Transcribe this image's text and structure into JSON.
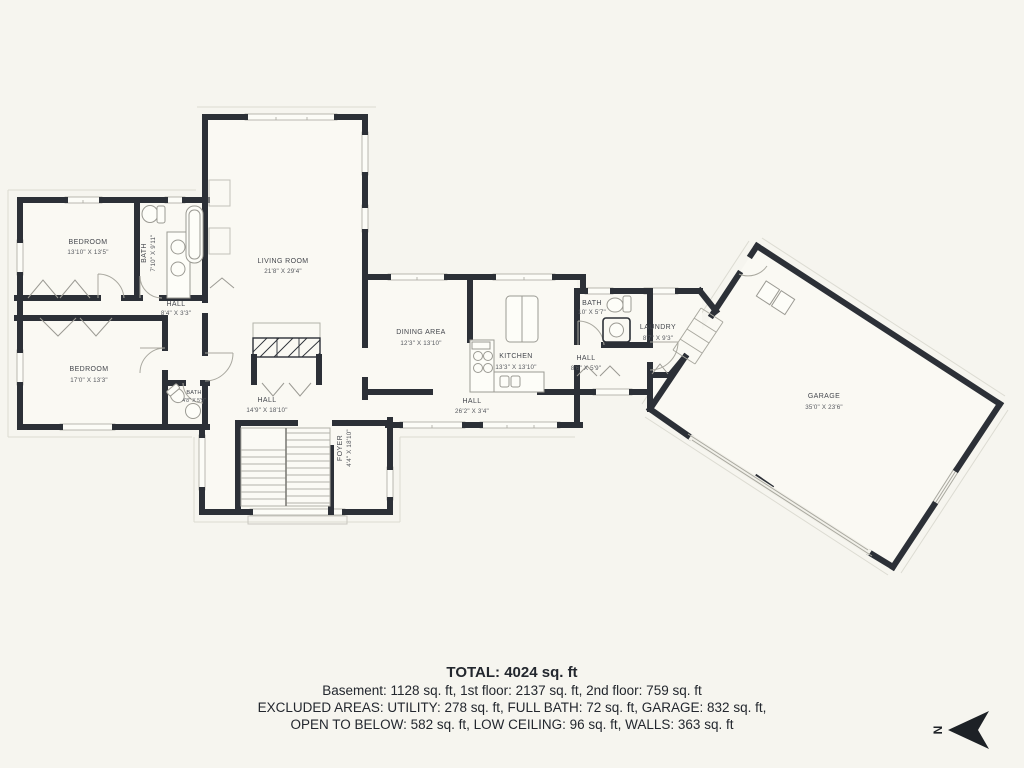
{
  "title": "Floor plan",
  "colors": {
    "background": "#f6f5ef",
    "wall": "#2c3037",
    "thin_line": "#a9a89f",
    "eave_line": "#dcdbd2",
    "label": "#44474d"
  },
  "rooms": {
    "living_room": {
      "name": "LIVING ROOM",
      "dims": "21'8\" X 29'4\""
    },
    "bedroom_upper": {
      "name": "BEDROOM",
      "dims": "13'10\" X 13'5\""
    },
    "bath_upper": {
      "name": "BATH",
      "dims": "7'10\" X 9'11\""
    },
    "hall_bedrooms": {
      "name": "HALL",
      "dims": "8'4\" X 3'3\""
    },
    "bedroom_lower": {
      "name": "BEDROOM",
      "dims": "17'0\" X 13'3\""
    },
    "bath_small": {
      "name": "BATH",
      "dims": "4'8\" X 5'9\""
    },
    "hall_center": {
      "name": "HALL",
      "dims": "14'9\" X 18'10\""
    },
    "foyer": {
      "name": "FOYER",
      "dims": "4'4\" X 18'10\""
    },
    "dining": {
      "name": "DINING AREA",
      "dims": "12'3\" X 13'10\""
    },
    "kitchen": {
      "name": "KITCHEN",
      "dims": "13'3\" X 13'10\""
    },
    "hall_long": {
      "name": "HALL",
      "dims": "26'2\" X 3'4\""
    },
    "bath_main": {
      "name": "BATH",
      "dims": "10' X 5'7\""
    },
    "hall_rear": {
      "name": "HALL",
      "dims": "8'6\" X 5'9\""
    },
    "laundry": {
      "name": "LAUNDRY",
      "dims": "8'7\" X 9'3\""
    },
    "garage": {
      "name": "GARAGE",
      "dims": "35'0\" X 23'6\""
    }
  },
  "summary": {
    "total": "TOTAL: 4024 sq. ft",
    "floors": "Basement: 1128 sq. ft, 1st floor: 2137 sq. ft, 2nd floor: 759 sq. ft",
    "excluded1": "EXCLUDED AREAS: UTILITY: 278 sq. ft, FULL BATH: 72 sq. ft, GARAGE: 832 sq. ft,",
    "excluded2": "OPEN TO BELOW: 582 sq. ft, LOW CEILING: 96 sq. ft, WALLS: 363 sq. ft"
  },
  "compass": {
    "label": "N"
  }
}
